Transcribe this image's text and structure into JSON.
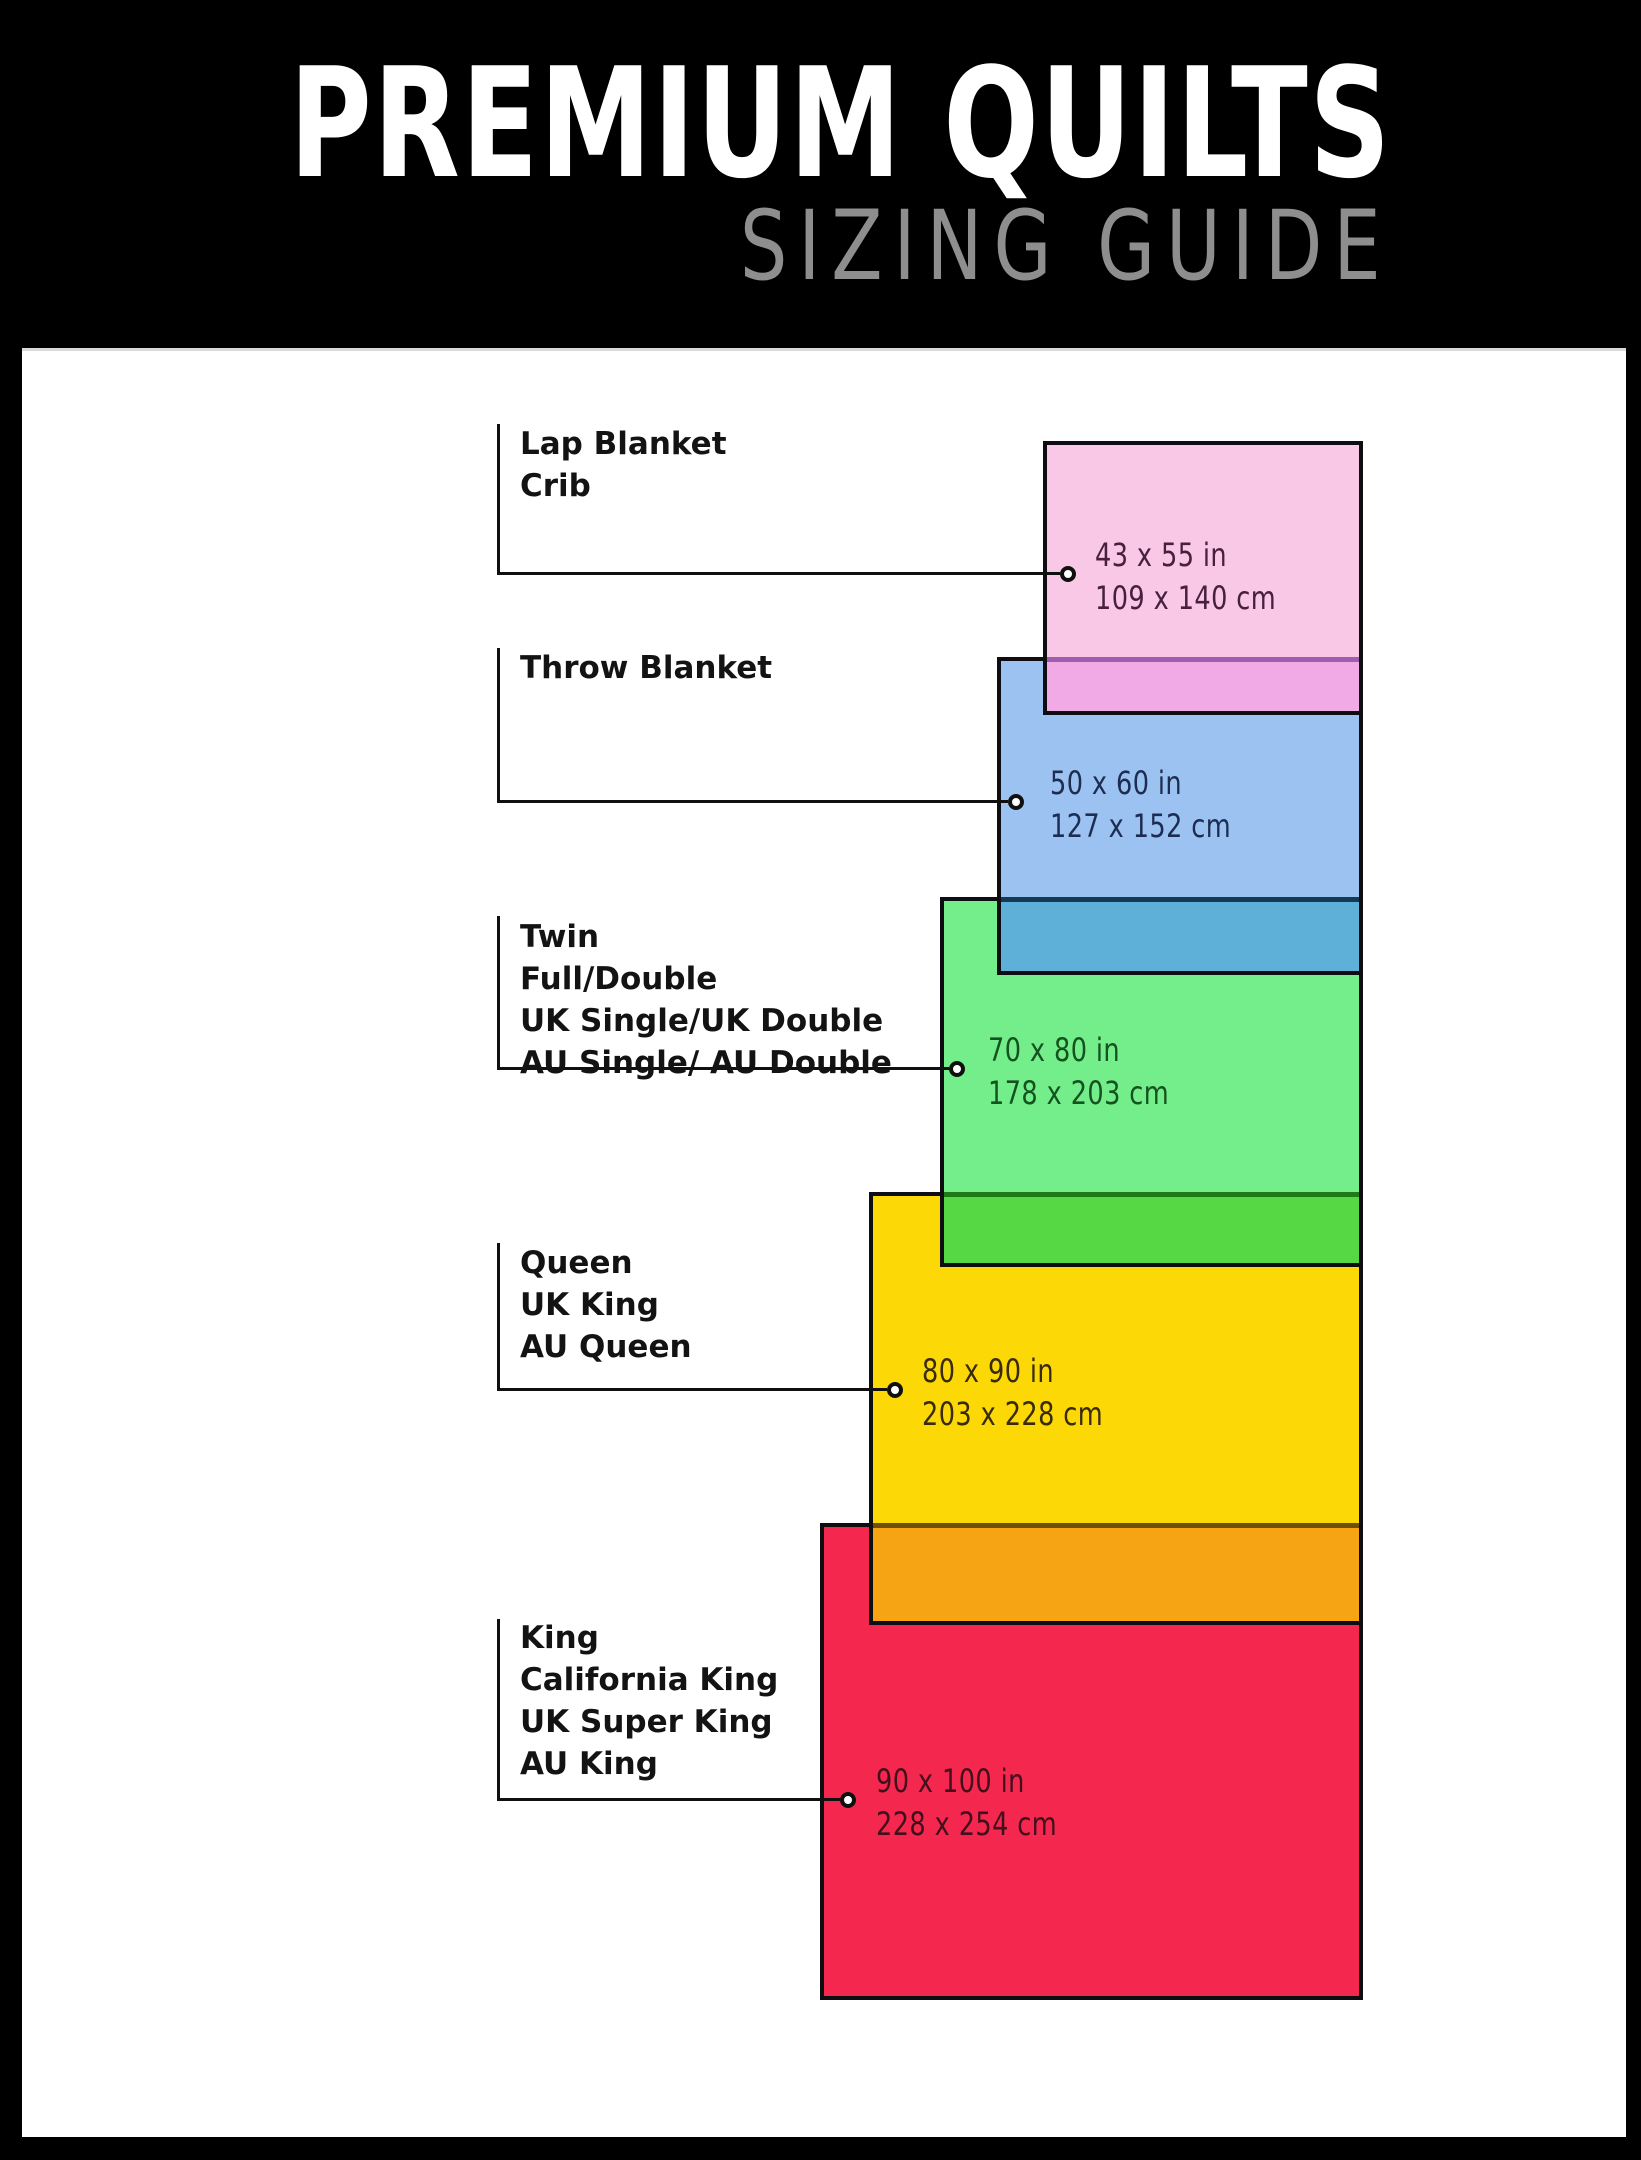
{
  "header": {
    "title": "PREMIUM QUILTS",
    "subtitle": "SIZING GUIDE",
    "background": "#000000",
    "title_color": "#ffffff",
    "subtitle_color": "#8e8e8e"
  },
  "canvas": {
    "background": "#ffffff",
    "frame_color": "#000000",
    "connector_line_color": "#101010"
  },
  "sizes": [
    {
      "id": "lap-blanket-crib",
      "name_lines": [
        "Lap Blanket",
        "Crib"
      ],
      "inches": "43 x 55 in",
      "cm": "109 x 140 cm",
      "fill": "#f9c8e6",
      "text_color": "#47203f",
      "overlap_fill_over_next": "#f2aae6",
      "overlap_border_tint": "#a05fae"
    },
    {
      "id": "throw-blanket",
      "name_lines": [
        "Throw Blanket"
      ],
      "inches": "50 x 60 in",
      "cm": "127 x 152 cm",
      "fill": "#9cc2f2",
      "text_color": "#1d2d52",
      "overlap_fill_over_next": "#5fb0d9",
      "overlap_border_tint": "#143a55"
    },
    {
      "id": "twin-full-double",
      "name_lines": [
        "Twin",
        "Full/Double",
        "UK Single/UK Double",
        "AU Single/ AU Double"
      ],
      "inches": "70 x 80 in",
      "cm": "178 x 203 cm",
      "fill": "#74ee8b",
      "text_color": "#14521f",
      "overlap_fill_over_next": "#55d844",
      "overlap_border_tint": "#1d7a16"
    },
    {
      "id": "queen-uk-king-au-queen",
      "name_lines": [
        "Queen",
        "UK King",
        "AU Queen"
      ],
      "inches": "80 x 90 in",
      "cm": "203 x 228 cm",
      "fill": "#fcd906",
      "text_color": "#3a2b08",
      "overlap_fill_over_next": "#f7a414",
      "overlap_border_tint": "#6e4f05"
    },
    {
      "id": "king-california-king",
      "name_lines": [
        "King",
        "California King",
        "UK Super King",
        "AU King"
      ],
      "inches": "90 x 100 in",
      "cm": "228 x 254 cm",
      "fill": "#f4284e",
      "text_color": "#420f1c"
    }
  ]
}
